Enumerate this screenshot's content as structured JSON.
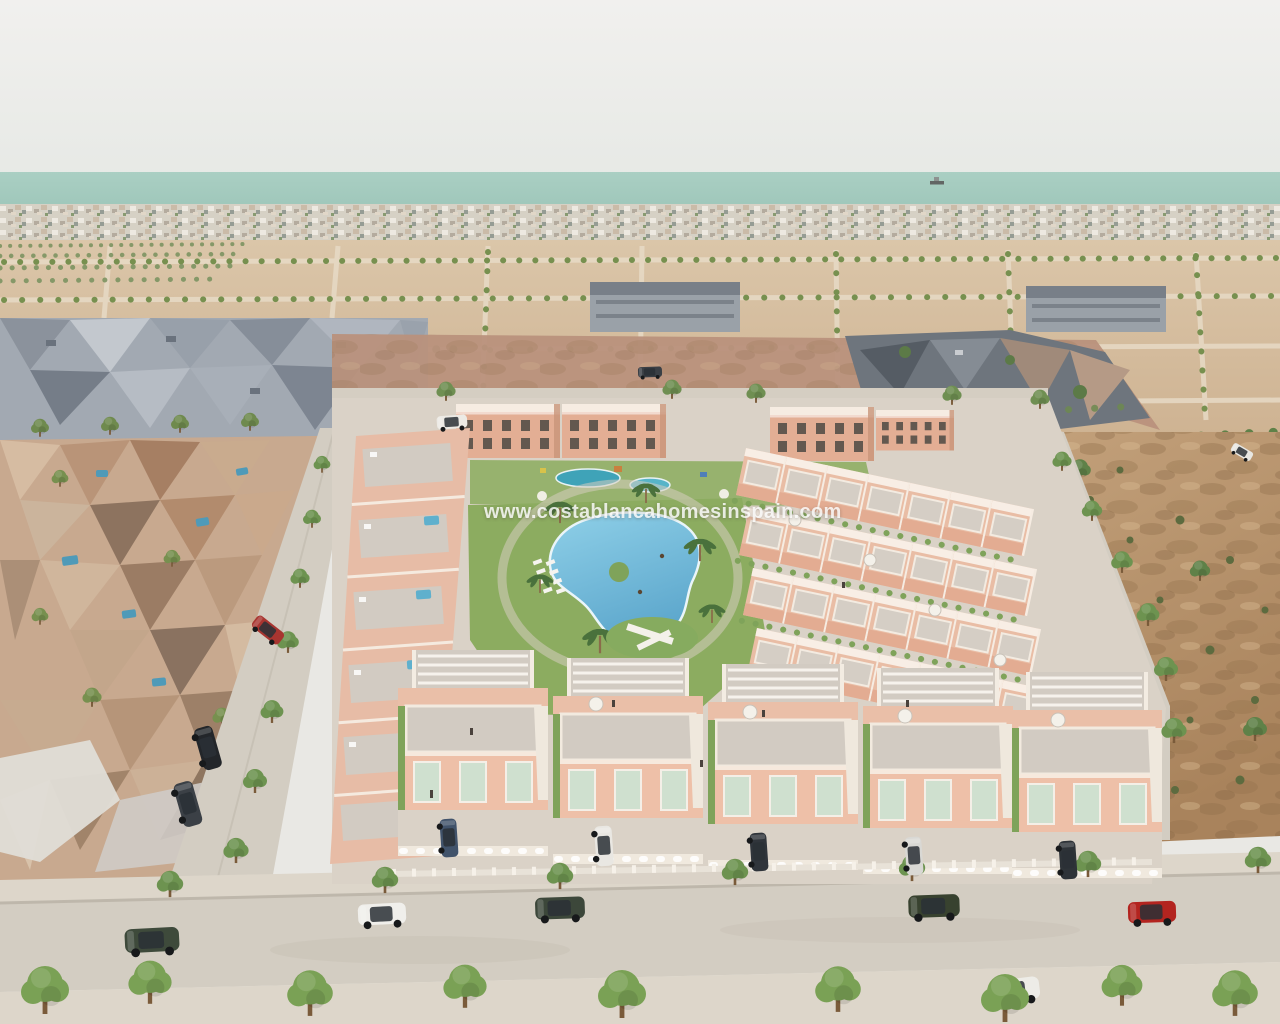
{
  "scene": {
    "type": "aerial-3d-architectural-render",
    "subject": "Aerial render of a new-build residential development with communal pool and gardens, beside an existing low-poly neighbourhood, vacant plots and the sea on the horizon",
    "watermark": {
      "text": "www.costablancahomesinspain.com"
    },
    "palette": {
      "sky_top": "#f1f0ee",
      "sky_bottom": "#e5e8e4",
      "sea": "#9cc5b8",
      "sea_light": "#aacfc3",
      "distant_town": "#d6d1c5",
      "land": "#dbc6a9",
      "land_far": "#cdb190",
      "scrub": "#b9917c",
      "dirt": "#c2a07a",
      "dirt_dark": "#a9835c",
      "road": "#d3cdc2",
      "paving": "#dad2c7",
      "sidewalk": "#ddd6ca",
      "wall_salmon": "#eabfa8",
      "wall_salmon_deep": "#e3ae94",
      "trim_white": "#f6ece2",
      "roof_terrace": "#d2cbc2",
      "window_shutter": "#cfe0cf",
      "pool_water": "#5ea8cd",
      "pool_water_light": "#8fd0e8",
      "lawn": "#8cac60",
      "tree_green": "#6d9350",
      "palm_green": "#4a713c",
      "existing_tan": "#c8a98f",
      "existing_gray": "#a2a9b2"
    },
    "vehicles": [
      {
        "color": "#3e4a3b",
        "type": "suv",
        "location": "bottom road west, parked"
      },
      {
        "color": "#f0efeb",
        "type": "suv",
        "location": "bottom road, parked"
      },
      {
        "color": "#3c473a",
        "type": "suv",
        "location": "bottom road centre, parked"
      },
      {
        "color": "#38422f",
        "type": "suv",
        "location": "bottom road east, parked"
      },
      {
        "color": "#b3241f",
        "type": "car",
        "location": "bottom road east, parked"
      },
      {
        "color": "#edece7",
        "type": "car",
        "location": "bottom road, driving"
      },
      {
        "color": "#23262a",
        "type": "suv",
        "location": "left road, parked"
      },
      {
        "color": "#3b4046",
        "type": "suv",
        "location": "left road, parked"
      },
      {
        "color": "#a83530",
        "type": "car",
        "location": "existing neighbourhood street"
      },
      {
        "color": "#41536b",
        "type": "car",
        "location": "villa driveway 1"
      },
      {
        "color": "#e9e7e2",
        "type": "van",
        "location": "villa driveway 2"
      },
      {
        "color": "#30353b",
        "type": "car",
        "location": "villa driveway 3"
      },
      {
        "color": "#d9d8d4",
        "type": "car",
        "location": "villa driveway 4"
      },
      {
        "color": "#2e3338",
        "type": "car",
        "location": "villa driveway 5"
      },
      {
        "color": "#eceae5",
        "type": "pickup",
        "location": "development top road"
      },
      {
        "color": "#e8e7e2",
        "type": "car",
        "location": "right perimeter road"
      },
      {
        "color": "#3a3f45",
        "type": "suv",
        "location": "vacant plots street"
      }
    ],
    "landmarks": [
      "sea horizon with ship",
      "distant coastal town",
      "vacant urbanised plots with tree-lined streets",
      "grey buildings under construction",
      "existing photogrammetry neighbourhood with small pools",
      "new salmon-pink townhouse development",
      "communal lagoon pool with palm trees",
      "kids pool and playground",
      "rooftop solariums with pergolas and parasols",
      "parked cars",
      "street trees"
    ]
  }
}
